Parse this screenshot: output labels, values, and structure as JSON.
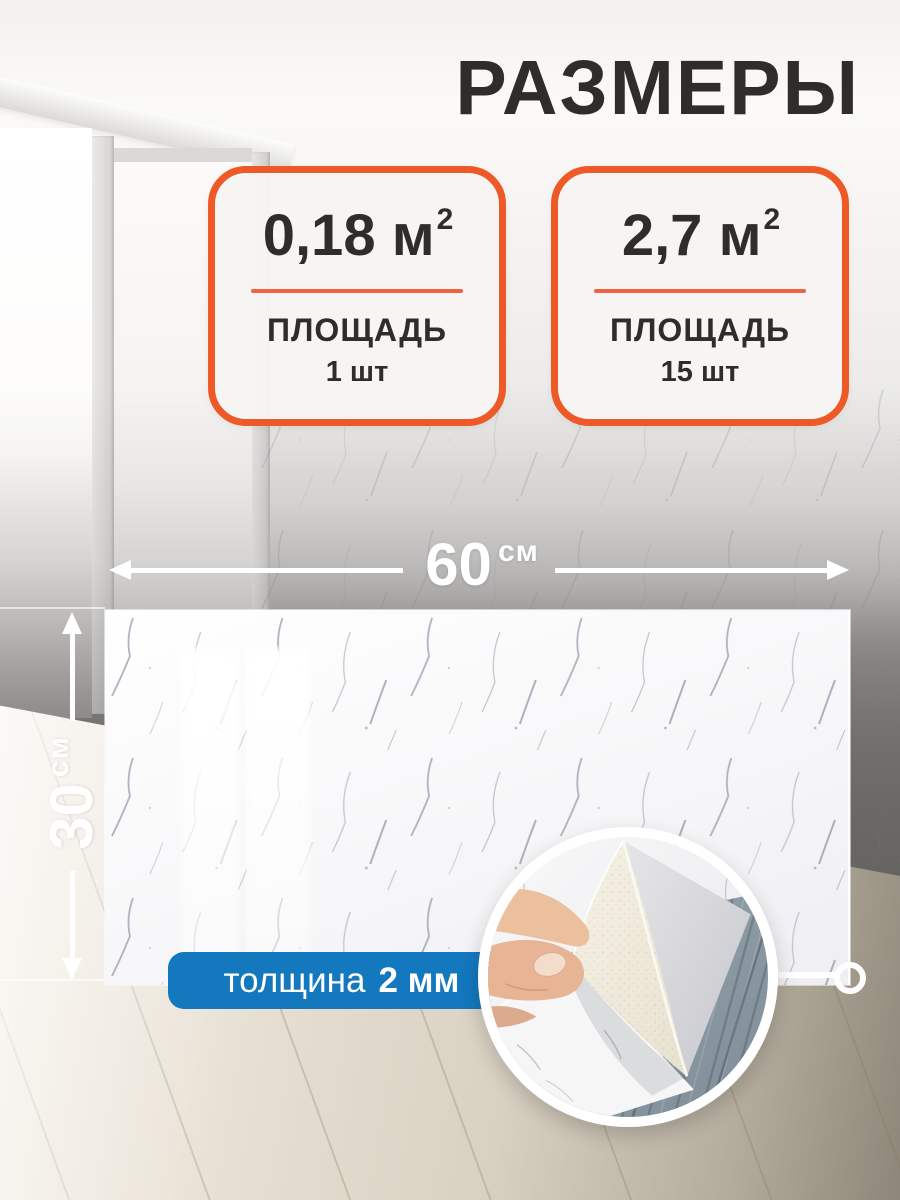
{
  "title": "РАЗМЕРЫ",
  "cards": [
    {
      "value": "0,18",
      "unit": "м",
      "unit_sup": "2",
      "label": "ПЛОЩАДЬ",
      "count": "1 шт"
    },
    {
      "value": "2,7",
      "unit": "м",
      "unit_sup": "2",
      "label": "ПЛОЩАДЬ",
      "count": "15 шт"
    }
  ],
  "dims": {
    "width_value": "60",
    "width_unit": "см",
    "height_value": "30",
    "height_unit": "см"
  },
  "badge": {
    "label": "толщина",
    "value": "2 мм"
  },
  "icons": {
    "width_arrow": "double-headed-horizontal-arrow",
    "height_arrow": "double-headed-vertical-arrow",
    "callout": "circle-callout-ring",
    "inset_photo": "peeling-corner-with-hand"
  },
  "colors": {
    "accent_orange": "#ed5a28",
    "badge_blue": "#1478be",
    "text_dark": "#2e2d2c",
    "arrow_white": "#ffffff"
  }
}
